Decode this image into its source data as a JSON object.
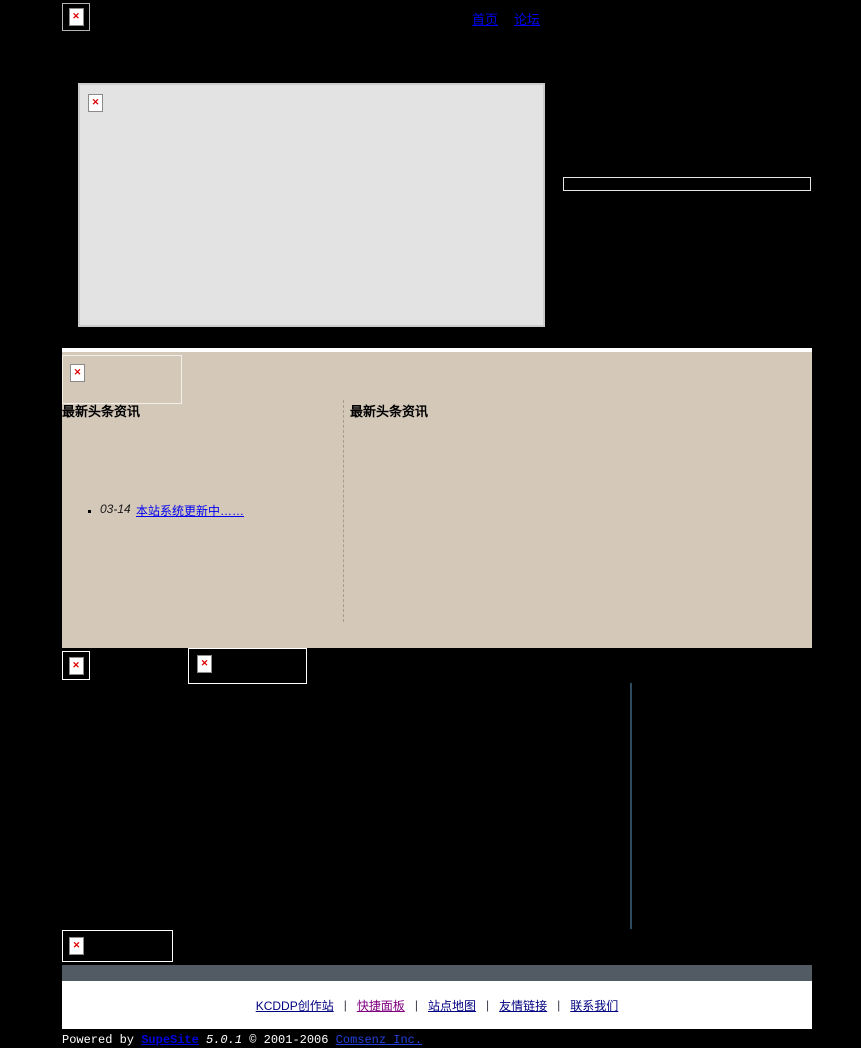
{
  "icons": {
    "broken_image": "✕"
  },
  "nav": {
    "home_label": "首页",
    "forum_label": "论坛"
  },
  "news_section": {
    "left_header": "最新头条资讯",
    "right_header": "最新头条资讯",
    "items": [
      {
        "date": "03-14",
        "title": "本站系统更新中……"
      }
    ]
  },
  "footer": {
    "links": [
      {
        "label": "KCDDP创作站"
      },
      {
        "label": "快捷面板"
      },
      {
        "label": "站点地图"
      },
      {
        "label": "友情链接"
      },
      {
        "label": "联系我们"
      }
    ],
    "separator": "|",
    "powered": {
      "prefix": "Powered by",
      "product": "SupeSite",
      "version": "5.0.1",
      "copyright": "© 2001-2006",
      "company": "Comsenz Inc."
    }
  },
  "colors": {
    "page_background": "#000000",
    "link_blue": "#0000ee",
    "footer_link_navy": "#000080",
    "footer_link_visited": "#800080",
    "beige_section": "#d4c8b9",
    "gray_panel": "#e3e3e3",
    "gray_bar": "#525a63",
    "vertical_line": "#2d4a5e",
    "broken_icon_x": "#dd0000"
  }
}
